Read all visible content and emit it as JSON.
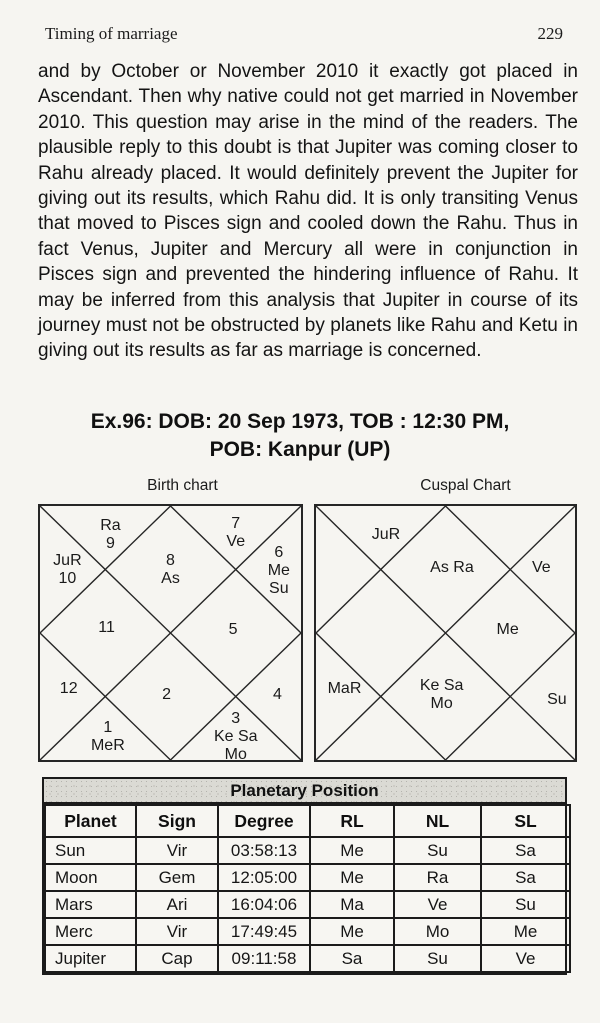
{
  "header": {
    "title": "Timing of marriage",
    "page_number": "229"
  },
  "paragraph": "and by October or November 2010 it exactly got placed in Ascendant. Then why native could not get married in November 2010. This question may arise in the mind of the readers. The plausible reply to this doubt is that Jupiter was coming closer to Rahu already placed. It would definitely prevent the Jupiter for giving out its results, which Rahu did. It is only transiting Venus that moved to Pisces sign and cooled down the Rahu. Thus in fact Venus, Jupiter and Mercury all were in conjunction in Pisces sign and prevented the hindering influence of Rahu. It may be inferred from this analysis that Jupiter in course of its journey must not be obstructed by planets like Rahu and Ketu in giving out its results as far as marriage is concerned.",
  "example_heading": {
    "line1": "Ex.96: DOB: 20 Sep 1973, TOB : 12:30 PM,",
    "line2": "POB: Kanpur (UP)"
  },
  "charts": {
    "birth": {
      "title": "Birth chart",
      "houses": {
        "top_left": "Ra\n9",
        "left_top": "JuR\n10",
        "top_diamond": "8\nAs",
        "top_right": "7\nVe",
        "right_top": "6\nMe\nSu",
        "left_diamond": "11",
        "right_diamond": "5",
        "left_bottom": "12",
        "bottom_left": "1\nMeR",
        "bottom_diamond": "2",
        "bottom_right": "3\nKe Sa Mo",
        "right_bottom": "4"
      }
    },
    "cuspal": {
      "title": "Cuspal Chart",
      "houses": {
        "top_left": "JuR",
        "top_diamond": "As Ra",
        "right_top": "Ve",
        "right_diamond": "Me",
        "left_bottom": "MaR",
        "bottom_diamond": "Ke Sa\nMo",
        "right_bottom": "Su"
      }
    }
  },
  "table": {
    "caption": "Planetary Position",
    "columns": [
      "Planet",
      "Sign",
      "Degree",
      "RL",
      "NL",
      "SL"
    ],
    "rows": [
      [
        "Sun",
        "Vir",
        "03:58:13",
        "Me",
        "Su",
        "Sa"
      ],
      [
        "Moon",
        "Gem",
        "12:05:00",
        "Me",
        "Ra",
        "Sa"
      ],
      [
        "Mars",
        "Ari",
        "16:04:06",
        "Ma",
        "Ve",
        "Su"
      ],
      [
        "Merc",
        "Vir",
        "17:49:45",
        "Me",
        "Mo",
        "Me"
      ],
      [
        "Jupiter",
        "Cap",
        "09:11:58",
        "Sa",
        "Su",
        "Ve"
      ]
    ]
  }
}
